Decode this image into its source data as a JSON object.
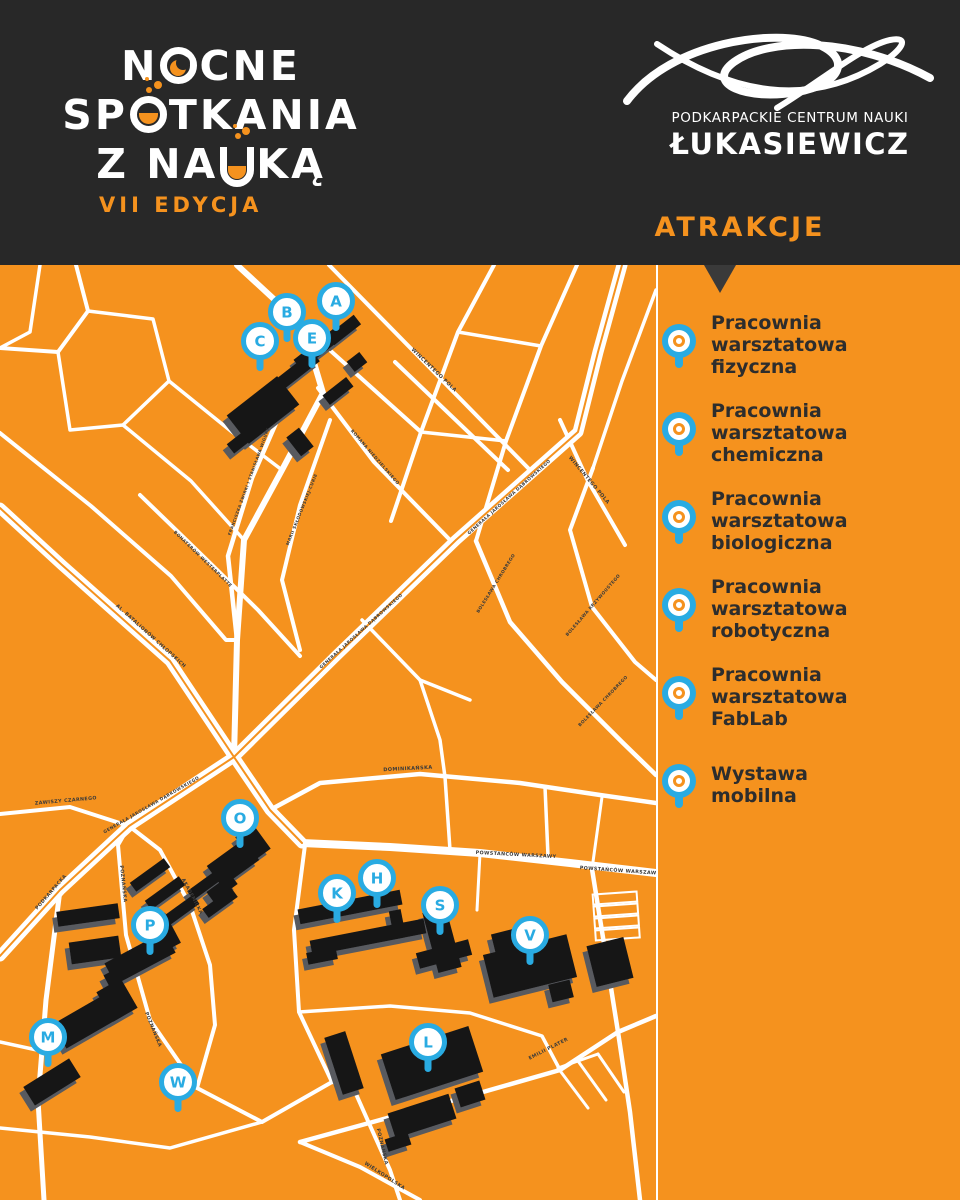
{
  "header": {
    "title_lines": [
      {
        "text": "NOCNE",
        "special": {
          "index": 1,
          "type": "moon-o"
        }
      },
      {
        "text": "SPOTKANIA",
        "special": {
          "index": 2,
          "type": "flask"
        }
      },
      {
        "text": "Z NAUKĄ",
        "special": {
          "index": 4,
          "type": "flask-u"
        }
      }
    ],
    "edition": "VII EDYCJA",
    "org": {
      "line1": "PODKARPACKIE CENTRUM NAUKI",
      "line2": "ŁUKASIEWICZ"
    },
    "attractions_heading": "ATRAKCJE"
  },
  "attractions": [
    {
      "icon": "map-pin-icon",
      "lines": [
        "Pracownia",
        "warsztatowa",
        "fizyczna"
      ]
    },
    {
      "icon": "map-pin-icon",
      "lines": [
        "Pracownia",
        "warsztatowa",
        "chemiczna"
      ]
    },
    {
      "icon": "map-pin-icon",
      "lines": [
        "Pracownia",
        "warsztatowa",
        "biologiczna"
      ]
    },
    {
      "icon": "map-pin-icon",
      "lines": [
        "Pracownia",
        "warsztatowa",
        "robotyczna"
      ]
    },
    {
      "icon": "map-pin-icon",
      "lines": [
        "Pracownia",
        "warsztatowa",
        "FabLab"
      ]
    },
    {
      "icon": "map-pin-icon",
      "lines": [
        "Wystawa",
        "mobilna"
      ]
    }
  ],
  "map": {
    "pins": [
      {
        "letter": "A",
        "x": 336,
        "y": 301
      },
      {
        "letter": "B",
        "x": 287,
        "y": 312
      },
      {
        "letter": "E",
        "x": 312,
        "y": 338
      },
      {
        "letter": "C",
        "x": 260,
        "y": 341
      },
      {
        "letter": "O",
        "x": 240,
        "y": 818
      },
      {
        "letter": "K",
        "x": 337,
        "y": 893
      },
      {
        "letter": "H",
        "x": 377,
        "y": 878
      },
      {
        "letter": "S",
        "x": 440,
        "y": 905
      },
      {
        "letter": "V",
        "x": 530,
        "y": 935
      },
      {
        "letter": "P",
        "x": 150,
        "y": 925
      },
      {
        "letter": "M",
        "x": 48,
        "y": 1037
      },
      {
        "letter": "W",
        "x": 178,
        "y": 1082
      },
      {
        "letter": "L",
        "x": 428,
        "y": 1042
      }
    ],
    "street_labels": [
      {
        "text": "WINCENTEGO POLA",
        "x": 433,
        "y": 371,
        "rot": 44,
        "size": 5
      },
      {
        "text": "WINCENTEGO POLA",
        "x": 588,
        "y": 481,
        "rot": 50,
        "size": 5
      },
      {
        "text": "ROMANA NIEDZIELSKIEGO",
        "x": 374,
        "y": 458,
        "rot": 49,
        "size": 4.3
      },
      {
        "text": "FRANCISZKA ŻWIRKI I STANISŁAWA WIGURY",
        "x": 250,
        "y": 482,
        "rot": -70,
        "size": 4
      },
      {
        "text": "MARII SKŁODOWSKIEJ-CURIE",
        "x": 303,
        "y": 510,
        "rot": -68,
        "size": 4.2
      },
      {
        "text": "GENERAŁA JAROSŁAWA DĄBROWSKIEGO",
        "x": 510,
        "y": 498,
        "rot": -42,
        "size": 4.3
      },
      {
        "text": "GENERAŁA JAROSŁAWA DĄBROWSKIEGO",
        "x": 362,
        "y": 632,
        "rot": -42,
        "size": 4.3
      },
      {
        "text": "GENERAŁA JAROSŁAWA DĄBROWSKIEGO",
        "x": 152,
        "y": 806,
        "rot": -30,
        "size": 4.3
      },
      {
        "text": "AL. BATALIONÓW CHŁOPSKICH",
        "x": 150,
        "y": 637,
        "rot": 42,
        "size": 4.8
      },
      {
        "text": "BOHATERÓW WESTERPLATTE",
        "x": 202,
        "y": 560,
        "rot": 44,
        "size": 4.3
      },
      {
        "text": "BOLESŁAWA CHROBREGO",
        "x": 497,
        "y": 584,
        "rot": -58,
        "size": 4.3
      },
      {
        "text": "BOLESŁAWA CHROBREGO",
        "x": 604,
        "y": 702,
        "rot": -46,
        "size": 4.3
      },
      {
        "text": "BOLESŁAWA KRZYWOUSTEGO",
        "x": 594,
        "y": 606,
        "rot": -49,
        "size": 4.3
      },
      {
        "text": "DOMINIKAŃSKA",
        "x": 408,
        "y": 770,
        "rot": -3,
        "size": 5
      },
      {
        "text": "POWSTAŃCÓW WARSZAWY",
        "x": 516,
        "y": 856,
        "rot": 3,
        "size": 4.8
      },
      {
        "text": "POWSTAŃCÓW WARSZAWY",
        "x": 620,
        "y": 872,
        "rot": 4,
        "size": 4.8
      },
      {
        "text": "ZAWISZY CZARNEGO",
        "x": 66,
        "y": 802,
        "rot": -5,
        "size": 4.8
      },
      {
        "text": "PODKARPACKA",
        "x": 52,
        "y": 893,
        "rot": -49,
        "size": 4.8
      },
      {
        "text": "POZNAŃSKA",
        "x": 122,
        "y": 884,
        "rot": 84,
        "size": 4.8
      },
      {
        "text": "POZNAŃSKA",
        "x": 152,
        "y": 1030,
        "rot": 68,
        "size": 4.8
      },
      {
        "text": "POZNAŃSKA",
        "x": 381,
        "y": 1147,
        "rot": 77,
        "size": 4.8
      },
      {
        "text": "AKADEMICKA",
        "x": 191,
        "y": 897,
        "rot": 62,
        "size": 4.8
      },
      {
        "text": "EMILII PLATER",
        "x": 549,
        "y": 1050,
        "rot": -27,
        "size": 4.8
      },
      {
        "text": "WIELKOPOLSKA",
        "x": 384,
        "y": 1177,
        "rot": 33,
        "size": 4.8
      }
    ]
  },
  "colors": {
    "orange": "#F5921E",
    "blue": "#29ABE2",
    "band": "#282828",
    "building": "#151515",
    "building_shadow": "#595A5E",
    "street": "#FFFFFF",
    "text_dark": "#2D2D2D"
  }
}
